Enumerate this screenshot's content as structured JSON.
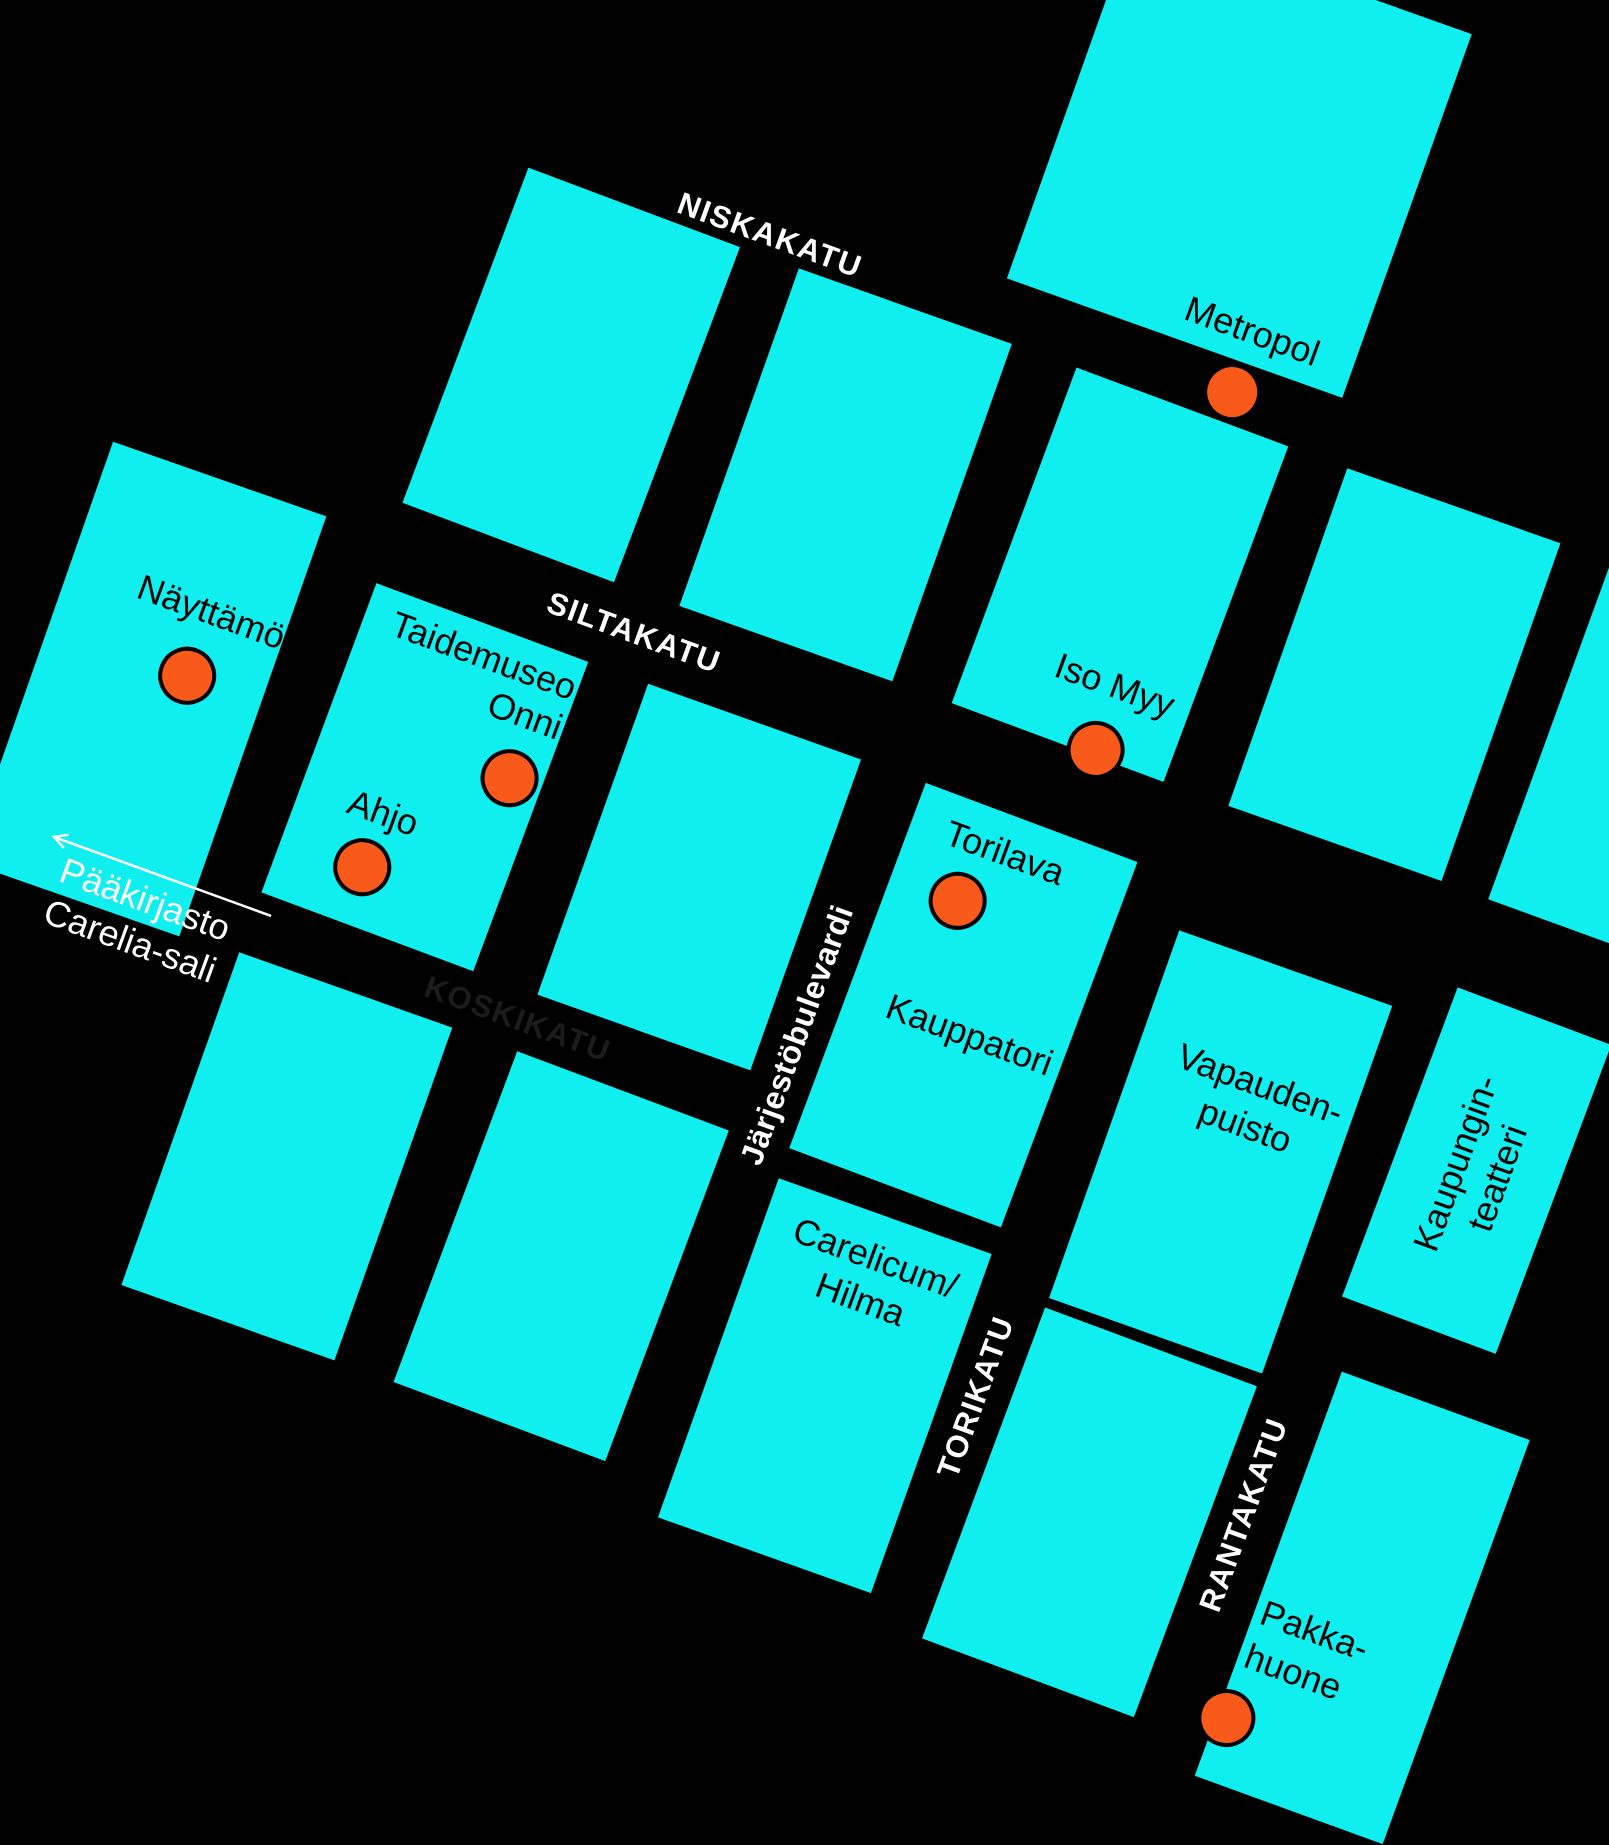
{
  "map_type": "stylized-city-grid-map",
  "colors": {
    "background": "#000000",
    "block": "#10EFF0",
    "marker": "#FA5A19",
    "marker_outline": "#000000",
    "street_label_light": "#FFFFFF",
    "street_label_dark": "#1C1C1C",
    "place_label": "#050505"
  },
  "streets": {
    "niskakatu": "NISKAKATU",
    "siltakatu": "SILTAKATU",
    "koskikatu": "KOSKIKATU",
    "jarjestobulevardi": "Järjestöbulevardi",
    "torikatu": "TORIKATU",
    "rantakatu": "RANTAKATU"
  },
  "places": {
    "metropol": "Metropol",
    "nayttamo": "Näyttämö",
    "taidemuseo": {
      "line1": "Taidemuseo",
      "line2": "Onni"
    },
    "ahjo": "Ahjo",
    "iso_myy": "Iso Myy",
    "torilava": "Torilava",
    "kauppatori": "Kauppatori",
    "vapaudenpuisto": {
      "line1": "Vapauden-",
      "line2": "puisto"
    },
    "kaupunginteatteri": {
      "line1": "Kaupungin-",
      "line2": "teatteri"
    },
    "carelicum": {
      "line1": "Carelicum/",
      "line2": "Hilma"
    },
    "pakkahuone": {
      "line1": "Pakka-",
      "line2": "huone"
    }
  },
  "offmap": {
    "line1": "Pääkirjasto",
    "line2": "Carelia-sali"
  },
  "markers": [
    "Metropol",
    "Näyttämö",
    "Taidemuseo Onni",
    "Ahjo",
    "Iso Myy",
    "Torilava",
    "Pakkahuone"
  ]
}
